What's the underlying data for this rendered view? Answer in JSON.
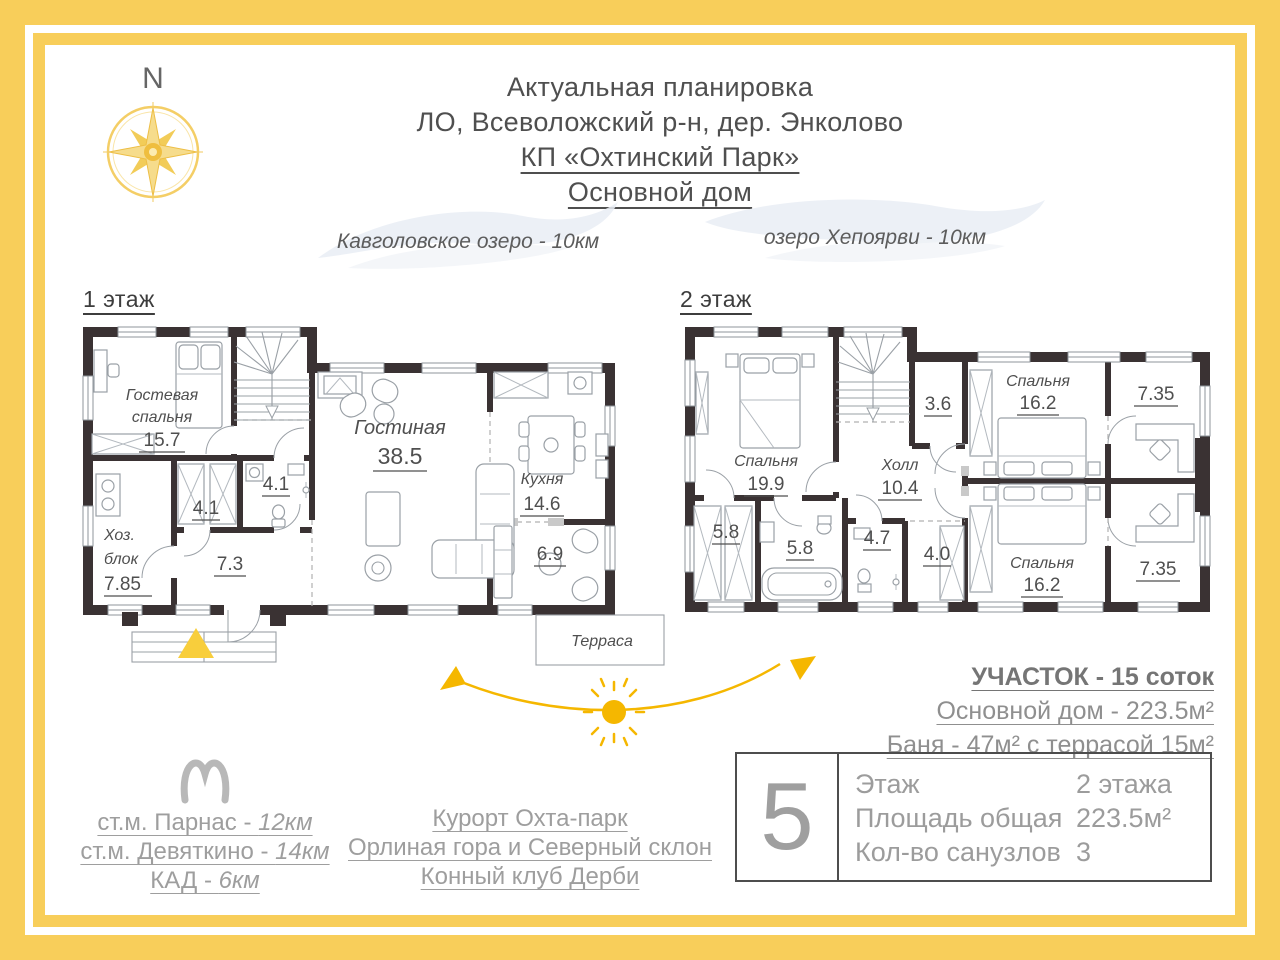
{
  "colors": {
    "frame_yellow": "#F8CE5A",
    "sun_yellow": "#F5B700",
    "wall_dark": "#3A3233",
    "text_dark": "#4F4F4F",
    "text_gray": "#9E9E9E"
  },
  "compass": {
    "label": "N"
  },
  "title": {
    "line1": "Актуальная планировка",
    "line2": "ЛО, Всеволожский р-н, дер. Энколово",
    "line3": "КП «Охтинский Парк»",
    "line4": "Основной дом"
  },
  "lakes": {
    "left": "Кавголовское озеро - 10км",
    "right": "озеро Хепоярви - 10км"
  },
  "floor1": {
    "heading": "1 этаж",
    "rooms": [
      {
        "n1": "Гостевая",
        "n2": "спальня",
        "a": "15.7"
      },
      {
        "n1": "Гостиная",
        "a": "38.5"
      },
      {
        "n1": "Кухня",
        "a": "14.6"
      },
      {
        "n1": "Хоз.",
        "n2": "блок",
        "a": "7.85"
      },
      {
        "a": "7.3"
      },
      {
        "a": "4.1"
      },
      {
        "a": "4.1"
      },
      {
        "a": "6.9"
      },
      {
        "n1": "Терраса"
      }
    ]
  },
  "floor2": {
    "heading": "2 этаж",
    "rooms": [
      {
        "n1": "Спальня",
        "a": "19.9"
      },
      {
        "n1": "Холл",
        "a": "10.4"
      },
      {
        "a": "3.6"
      },
      {
        "a": "5.8"
      },
      {
        "a": "5.8"
      },
      {
        "a": "4.7"
      },
      {
        "a": "4.0"
      },
      {
        "n1": "Спальня",
        "a": "16.2"
      },
      {
        "n1": "Спальня",
        "a": "16.2"
      },
      {
        "a": "7.35"
      },
      {
        "a": "7.35"
      }
    ]
  },
  "plot": {
    "line1": "УЧАСТОК - 15 соток",
    "line2": "Основной дом - 223.5м²",
    "line3": "Баня - 47м² с террасой 15м²"
  },
  "transport": {
    "lines": [
      {
        "label": "ст.м. Парнас - ",
        "dist": "12км"
      },
      {
        "label": "ст.м. Девяткино - ",
        "dist": "14км"
      },
      {
        "label": "КАД - ",
        "dist": "6км"
      }
    ]
  },
  "attractions": [
    "Курорт Охта-парк",
    "Орлиная гора  и Северный склон",
    "Конный клуб Дерби"
  ],
  "summary": {
    "number": "5",
    "rows": [
      {
        "label": "Этаж",
        "value": "2 этажа"
      },
      {
        "label": "Площадь общая",
        "value": "223.5м²"
      },
      {
        "label": "Кол-во санузлов",
        "value": "3"
      }
    ]
  }
}
